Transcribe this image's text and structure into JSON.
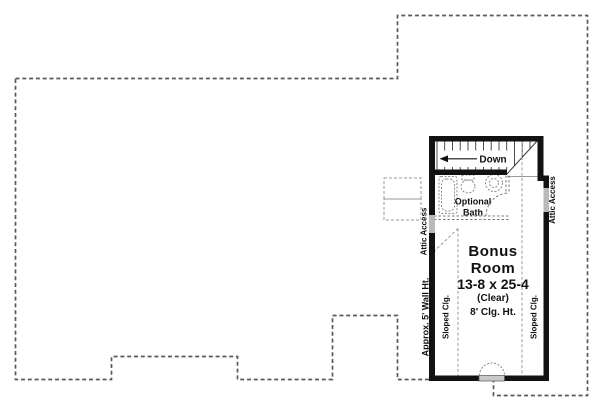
{
  "floor_plan": {
    "stairs": {
      "down_label": "Down"
    },
    "optional_bath": {
      "line1": "Optional",
      "line2": "Bath"
    },
    "bonus_room": {
      "name_line1": "Bonus",
      "name_line2": "Room",
      "dimensions": "13-8 x 25-4",
      "clear_note": "(Clear)",
      "ceiling_note": "8' Clg. Ht."
    },
    "annotations": {
      "attic_access_left": "Attic Access",
      "attic_access_right": "Attic Access",
      "wall_height": "Approx. 5' Wall Ht.",
      "sloped_clg_left": "Sloped Clg.",
      "sloped_clg_right": "Sloped Clg."
    },
    "colors": {
      "wall": "#121212",
      "roof_outline": "#5a5a5a",
      "wall_opening": "#b9b9b9",
      "fixture_line": "#8a8a8a"
    }
  }
}
